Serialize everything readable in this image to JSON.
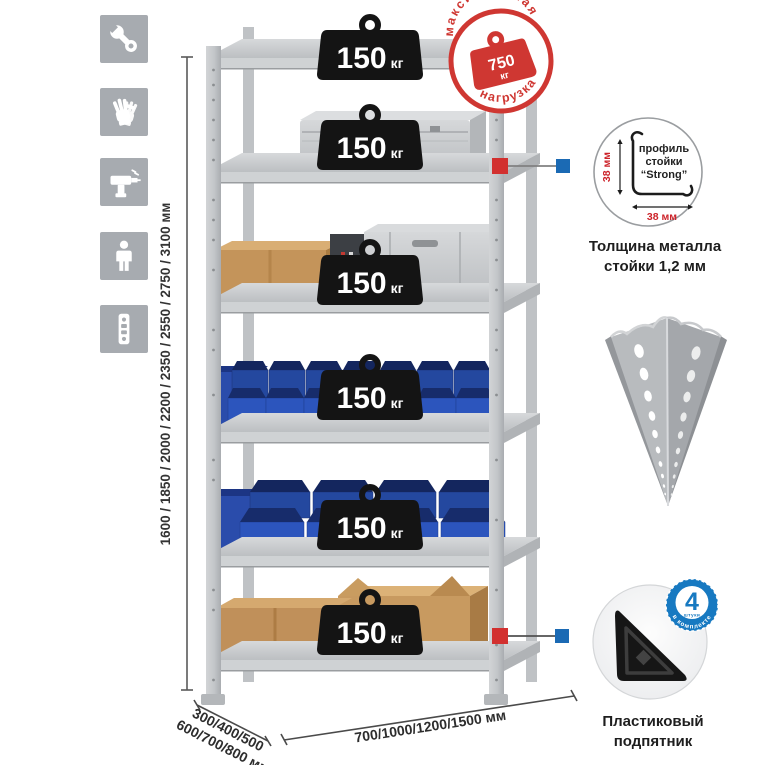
{
  "legend_icons": {
    "tile_color": "#a7abb0",
    "items": [
      {
        "name": "wrench"
      },
      {
        "name": "gloves"
      },
      {
        "name": "drill"
      },
      {
        "name": "person"
      },
      {
        "name": "perforated-profile"
      }
    ]
  },
  "rack": {
    "shelf_count": 6,
    "load_value": "150",
    "load_unit": "кг"
  },
  "max_load_stamp": {
    "arc_top": "максимальная",
    "arc_bottom": "нагрузка",
    "value": "750",
    "unit": "кг",
    "color": "#cf3732"
  },
  "dimensions": {
    "height": "1600 / 1850 / 2000 / 2200 / 2350 / 2550 / 2750 / 3100 мм",
    "depth_line1": "300/400/500",
    "depth_line2": "600/700/800 мм",
    "width": "700/1000/1200/1500 мм"
  },
  "callout_colors": {
    "marker_red": "#d2302f",
    "marker_blue": "#1b6ab4"
  },
  "profile_detail": {
    "label_line1": "профиль",
    "label_line2": "стойки",
    "label_line3": "“Strong”",
    "dim_vertical": "38 мм",
    "dim_horizontal": "38 мм",
    "caption_line1": "Толщина металла",
    "caption_line2": "стойки 1,2 мм"
  },
  "foot_detail": {
    "badge_value": "4",
    "badge_small": "штуки",
    "badge_arc": "в комплекте",
    "badge_color": "#1779c1",
    "caption_line1": "Пластиковый",
    "caption_line2": "подпятник"
  }
}
